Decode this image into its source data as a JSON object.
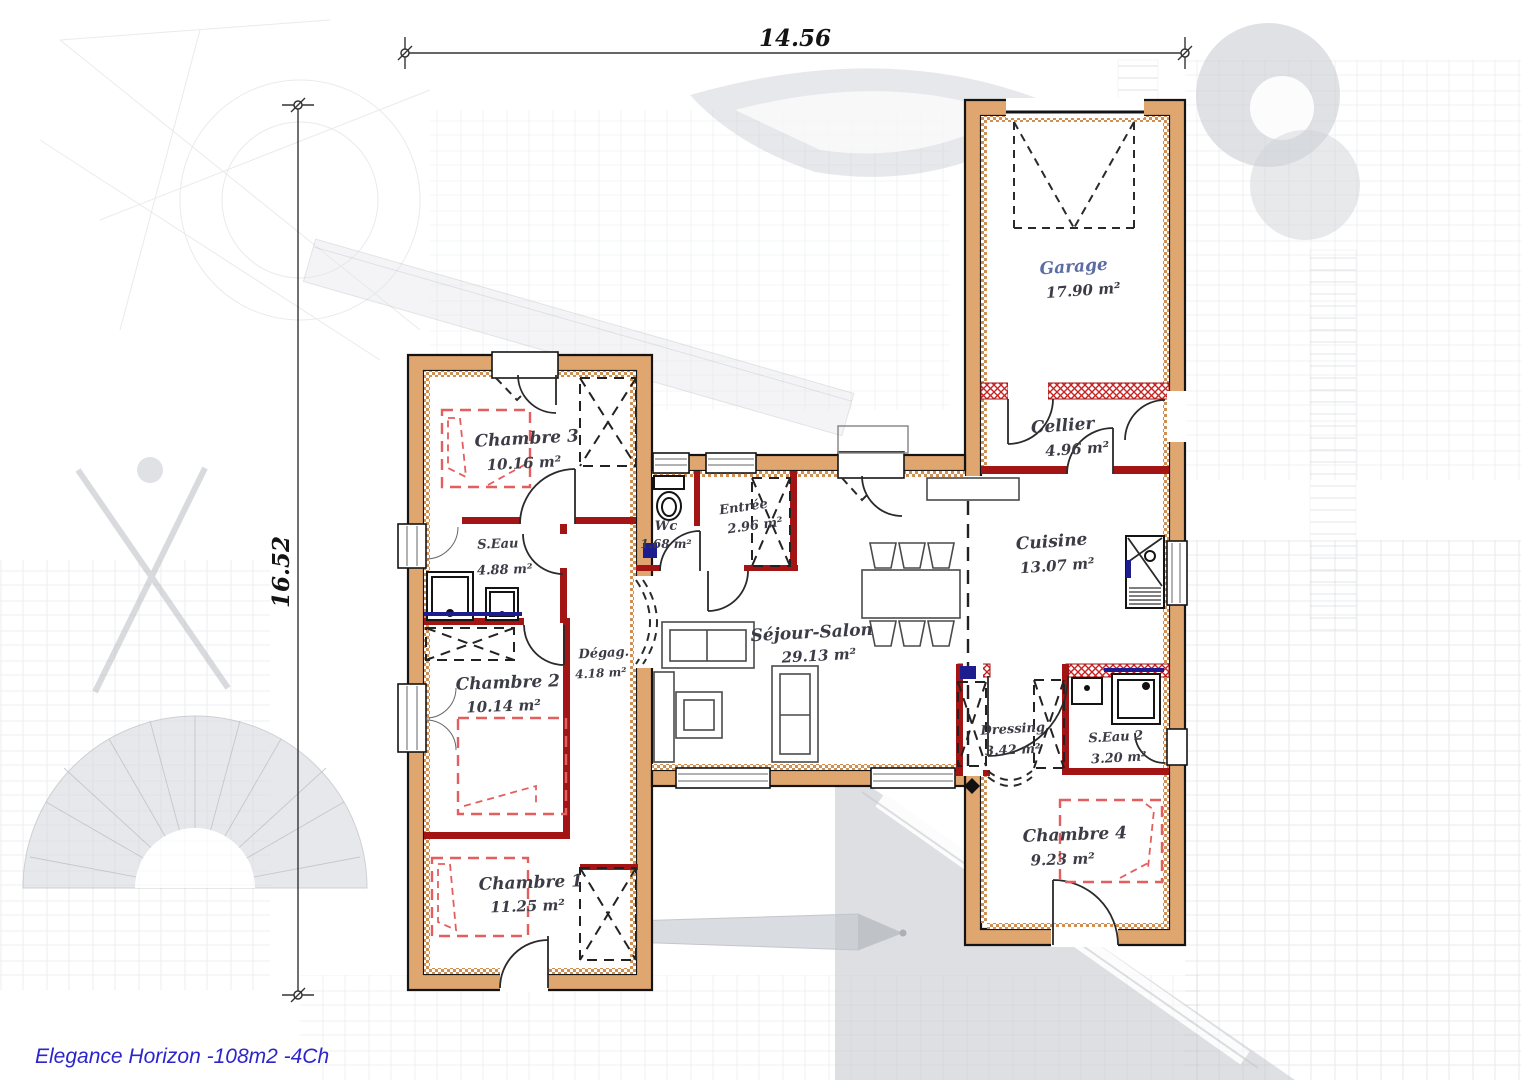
{
  "title": "Elegance Horizon -108m2 -4Ch",
  "dimensions": {
    "width_label": "14.56",
    "height_label": "16.52"
  },
  "rooms": [
    {
      "name": "Garage",
      "area": "17.90 m²"
    },
    {
      "name": "Cellier",
      "area": "4.96 m²"
    },
    {
      "name": "Cuisine",
      "area": "13.07 m²"
    },
    {
      "name": "Séjour-Salon",
      "area": "29.13 m²"
    },
    {
      "name": "Entrée",
      "area": "2.96 m²"
    },
    {
      "name": "Wc",
      "area": "1.68 m²"
    },
    {
      "name": "Dégag.",
      "area": "4.18 m²"
    },
    {
      "name": "Chambre 3",
      "area": "10.16 m²"
    },
    {
      "name": "S.Eau",
      "area": "4.88 m²"
    },
    {
      "name": "Chambre 2",
      "area": "10.14 m²"
    },
    {
      "name": "Chambre 1",
      "area": "11.25 m²"
    },
    {
      "name": "Dressing",
      "area": "3.42 m²"
    },
    {
      "name": "S.Eau 2",
      "area": "3.20 m²"
    },
    {
      "name": "Chambre 4",
      "area": "9.23 m²"
    }
  ],
  "colors": {
    "wall_fill": "#dfa76f",
    "partition_red": "#a31414",
    "hatch_red": "#cc2222",
    "bed_outline": "#e35f5f",
    "plumbing_navy": "#1d1d8f",
    "title_blue": "#2d24cc",
    "garage_label_blue": "#5c6da3"
  }
}
